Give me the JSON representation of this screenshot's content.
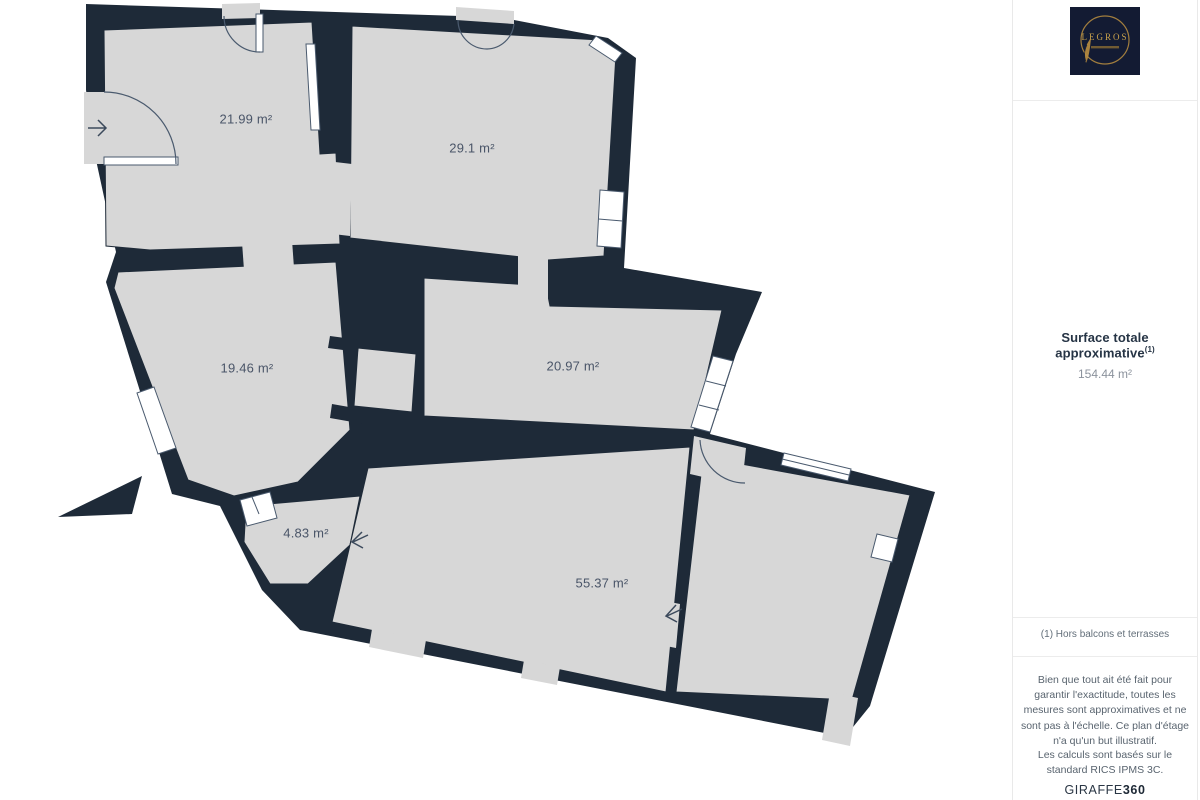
{
  "plan": {
    "rooms": [
      {
        "id": "room-1",
        "area_label": "21.99 m²"
      },
      {
        "id": "room-2",
        "area_label": "29.1 m²"
      },
      {
        "id": "room-3",
        "area_label": "19.46 m²"
      },
      {
        "id": "room-4",
        "area_label": "20.97 m²"
      },
      {
        "id": "room-5",
        "area_label": "4.83 m²"
      },
      {
        "id": "room-6",
        "area_label": "55.37 m²"
      }
    ],
    "colors": {
      "wall": "#1e2a38",
      "floor": "#d7d7d7",
      "label": "#4a5568",
      "window": "#ffffff"
    }
  },
  "sidebar": {
    "logo": {
      "text": "LEGROS",
      "bg": "#131b33",
      "accent": "#b3893f"
    },
    "summary": {
      "title": "Surface totale approximative",
      "title_superscript": "(1)",
      "value": "154.44 m²"
    },
    "footnote": "(1) Hors balcons et terrasses",
    "disclaimer_1": "Bien que tout ait été fait pour garantir l'exactitude, toutes les mesures sont approximatives et ne sont pas à l'échelle. Ce plan d'étage n'a qu'un but illustratif.",
    "disclaimer_2": "Les calculs sont basés sur le standard RICS IPMS 3C.",
    "brand": {
      "name": "GIRAFFE",
      "suffix": "360"
    }
  }
}
